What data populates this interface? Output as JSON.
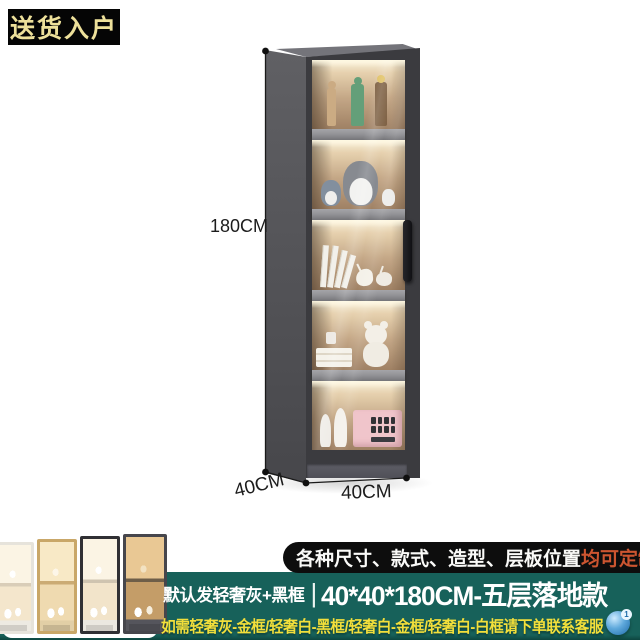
{
  "delivery_badge": {
    "text": "送货入户"
  },
  "dimension_labels": {
    "height": "180CM",
    "depth": "40CM",
    "width": "40CM"
  },
  "cabinet": {
    "description": "tall gray five-shelf glass-door display cabinet with warm interior lighting",
    "shelf_items": [
      "anime-action-figures",
      "totoro-plush-toys",
      "leaning-books-and-deer-ornaments",
      "teddy-bear-books-and-cup",
      "mannequin-heads-and-pink-box"
    ]
  },
  "variants": {
    "thumbnails": [
      {
        "name": "light-lux-white-with-white-frame"
      },
      {
        "name": "light-lux-gold-frame"
      },
      {
        "name": "light-lux-white-with-black-frame"
      },
      {
        "name": "light-lux-gray-with-gold-interior"
      }
    ]
  },
  "customize_badge": {
    "text": "各种尺寸、款式、造型、层板位置",
    "highlight": "均可定制"
  },
  "product_line": {
    "default_note": "默认发轻奢灰+黑框",
    "divider": "|",
    "spec": "40*40*180CM-五层落地款"
  },
  "service_line": {
    "text": "如需轻奢灰-金框/轻奢白-黑框/轻奢白-金框/轻奢白-白框请下单联系客服",
    "icon_badge": "1"
  },
  "colors": {
    "teal_background": "#17615A",
    "yellow_text": "#F2DF3B",
    "highlight_orange": "#CC5530",
    "badge_gold_text": "#EDE09A",
    "cabinet_frame_gray": "#3B3B3F"
  }
}
